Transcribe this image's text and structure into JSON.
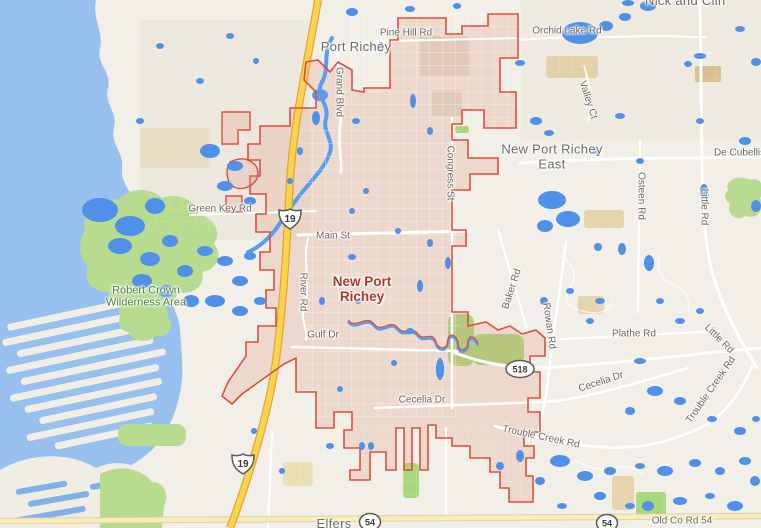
{
  "map": {
    "city_labels": {
      "port_richey": "Port Richey",
      "new_port_richey_east": "New Port Richey East",
      "new_port_richey": "New Port Richey",
      "elfers": "Elfers",
      "nick_and": "Nick and Clin"
    },
    "area_labels": {
      "robert_crown": "Robert Crown Wilderness Area"
    },
    "road_labels": {
      "pine_hill_rd": "Pine Hill Rd",
      "orchid_lake_rd": "Orchid Lake Rd",
      "grand_blvd": "Grand Blvd",
      "green_key_rd": "Green Key Rd",
      "main_st": "Main St",
      "river_rd": "River Rd",
      "congress_st": "Congress St",
      "baker_rd": "Baker Rd",
      "gulf_dr": "Gulf Dr",
      "cecelia_dr": "Cecelia Dr",
      "cecelia_dr_e": "Cecelia Dr",
      "valley_ct": "Valley Ct",
      "de_cubellis": "De Cubellis",
      "osteen_rd": "Osteen Rd",
      "little_rd_n": "Little Rd",
      "little_rd_s": "Little Rd",
      "rowan_rd": "Rowan Rd",
      "plathe_rd": "Plathe Rd",
      "trouble_creek_rd_w": "Trouble Creek Rd",
      "trouble_creek_rd_e": "Trouble Creek Rd",
      "old_co_rd_54": "Old Co Rd 54"
    },
    "shields": {
      "us19": "19",
      "fl518": "518",
      "fl54": "54"
    },
    "colors": {
      "water": "#97c0ee",
      "pond": "#4f90e8",
      "park": "#b7dc8f",
      "land": "#f2efe8",
      "city_fill": "#de9d85",
      "city_boundary": "#dd4f3d",
      "highway_fill": "#fbd44c",
      "highway_casing": "#e6a33c",
      "road": "#ffffff"
    }
  }
}
